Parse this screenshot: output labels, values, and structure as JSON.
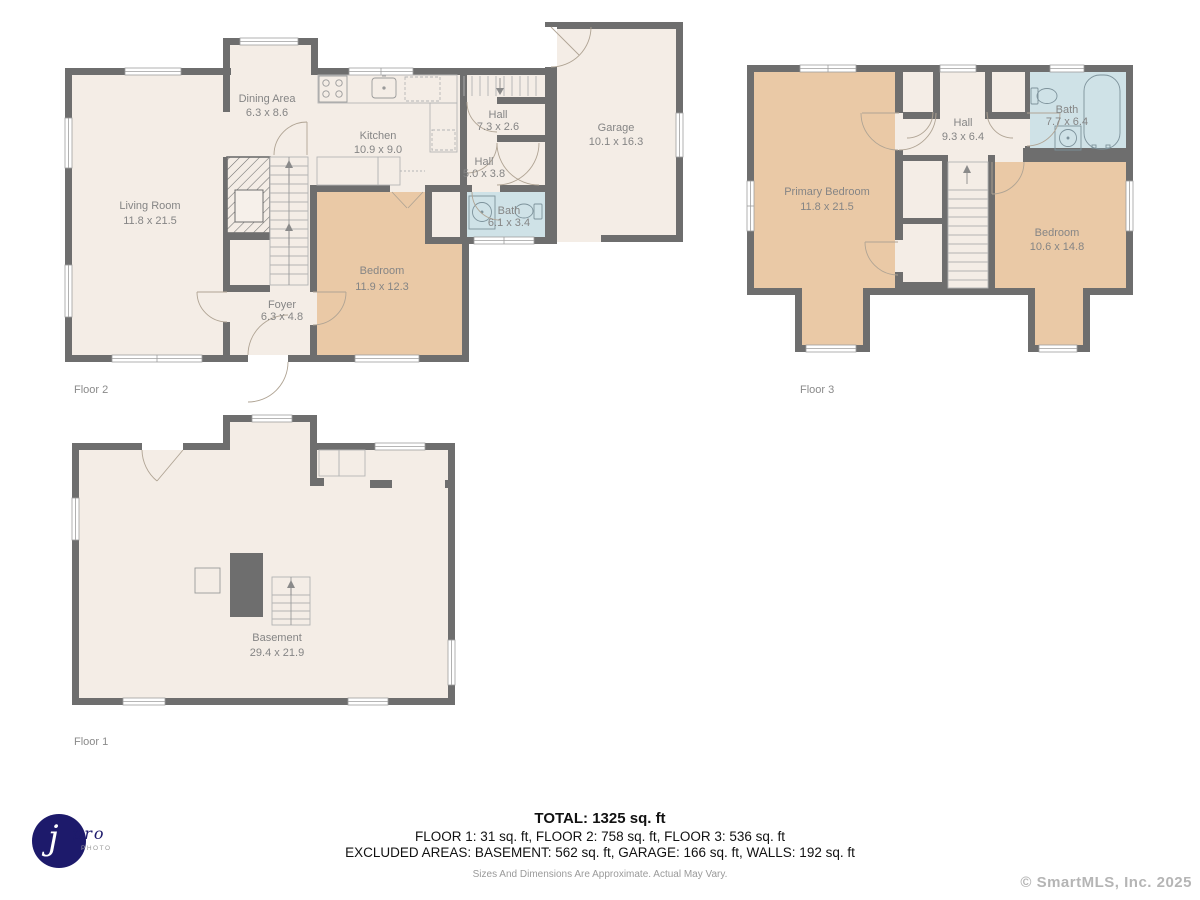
{
  "palette": {
    "wall": "#6e6e6e",
    "room_cream": "#f4ede6",
    "room_tan": "#eac9a6",
    "room_blue": "#cfe2e7",
    "label_gray": "#858585"
  },
  "floors": {
    "f2": {
      "label": "Floor 2",
      "rooms": {
        "living": {
          "name": "Living Room",
          "dims": "11.8 x 21.5"
        },
        "dining": {
          "name": "Dining Area",
          "dims": "6.3 x 8.6"
        },
        "kitchen": {
          "name": "Kitchen",
          "dims": "10.9 x 9.0"
        },
        "hall_upper": {
          "name": "Hall",
          "dims": "7.3 x 2.6"
        },
        "hall_lower": {
          "name": "Hall",
          "dims": "5.0 x 3.8"
        },
        "bath": {
          "name": "Bath",
          "dims": "6.1 x 3.4"
        },
        "garage": {
          "name": "Garage",
          "dims": "10.1 x 16.3"
        },
        "bedroom": {
          "name": "Bedroom",
          "dims": "11.9 x 12.3"
        },
        "foyer": {
          "name": "Foyer",
          "dims": "6.3 x 4.8"
        }
      }
    },
    "f3": {
      "label": "Floor 3",
      "rooms": {
        "primary": {
          "name": "Primary Bedroom",
          "dims": "11.8 x 21.5"
        },
        "hall": {
          "name": "Hall",
          "dims": "9.3 x 6.4"
        },
        "bath": {
          "name": "Bath",
          "dims": "7.7 x 6.4"
        },
        "bedroom": {
          "name": "Bedroom",
          "dims": "10.6 x 14.8"
        }
      }
    },
    "f1": {
      "label": "Floor 1",
      "rooms": {
        "basement": {
          "name": "Basement",
          "dims": "29.4 x 21.9"
        }
      }
    }
  },
  "summary": {
    "total": "TOTAL: 1325 sq. ft",
    "floors": "FLOOR 1: 31 sq. ft, FLOOR 2: 758 sq. ft, FLOOR 3: 536 sq. ft",
    "excluded": "EXCLUDED AREAS: BASEMENT: 562 sq. ft, GARAGE: 166 sq. ft, WALLS: 192 sq. ft",
    "disclaimer": "Sizes And Dimensions Are Approximate. Actual May Vary."
  },
  "branding": {
    "logo_j": "j",
    "logo_pro": "pro",
    "logo_photo": "PHOTO",
    "copyright": "© SmartMLS, Inc.  2025"
  }
}
